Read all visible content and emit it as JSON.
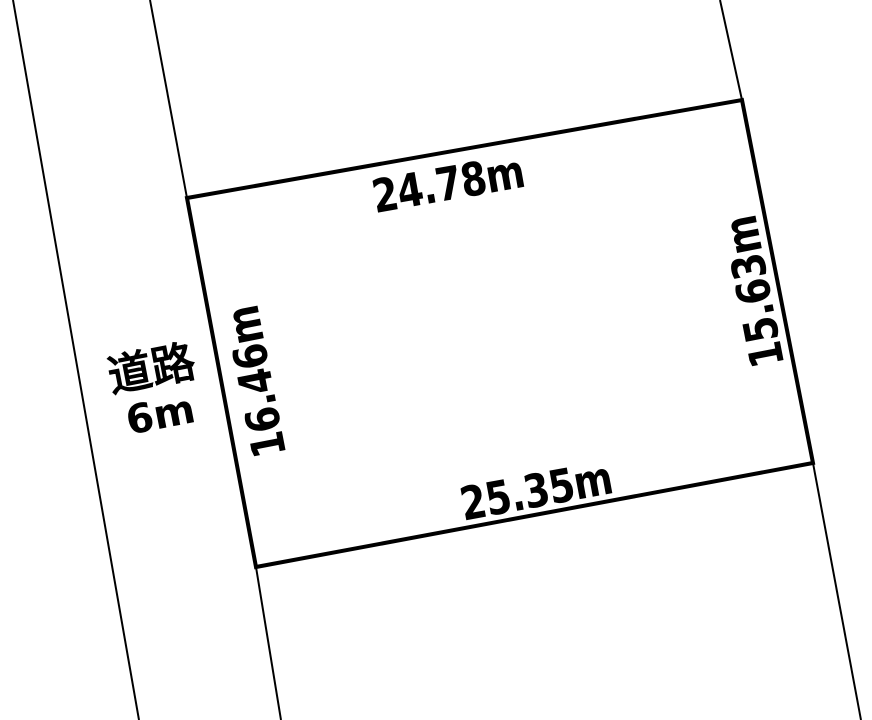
{
  "diagram_type": "land-plot-survey-sketch",
  "colors": {
    "background": "#ffffff",
    "line": "#000000",
    "text": "#000000",
    "text_halo": "#ffffff"
  },
  "parcel": {
    "top_edge_label": "24.78m",
    "right_edge_label": "15.63m",
    "bottom_edge_label": "25.35m",
    "left_edge_label": "16.46m"
  },
  "road": {
    "name": "道路",
    "width_label": "6m"
  }
}
